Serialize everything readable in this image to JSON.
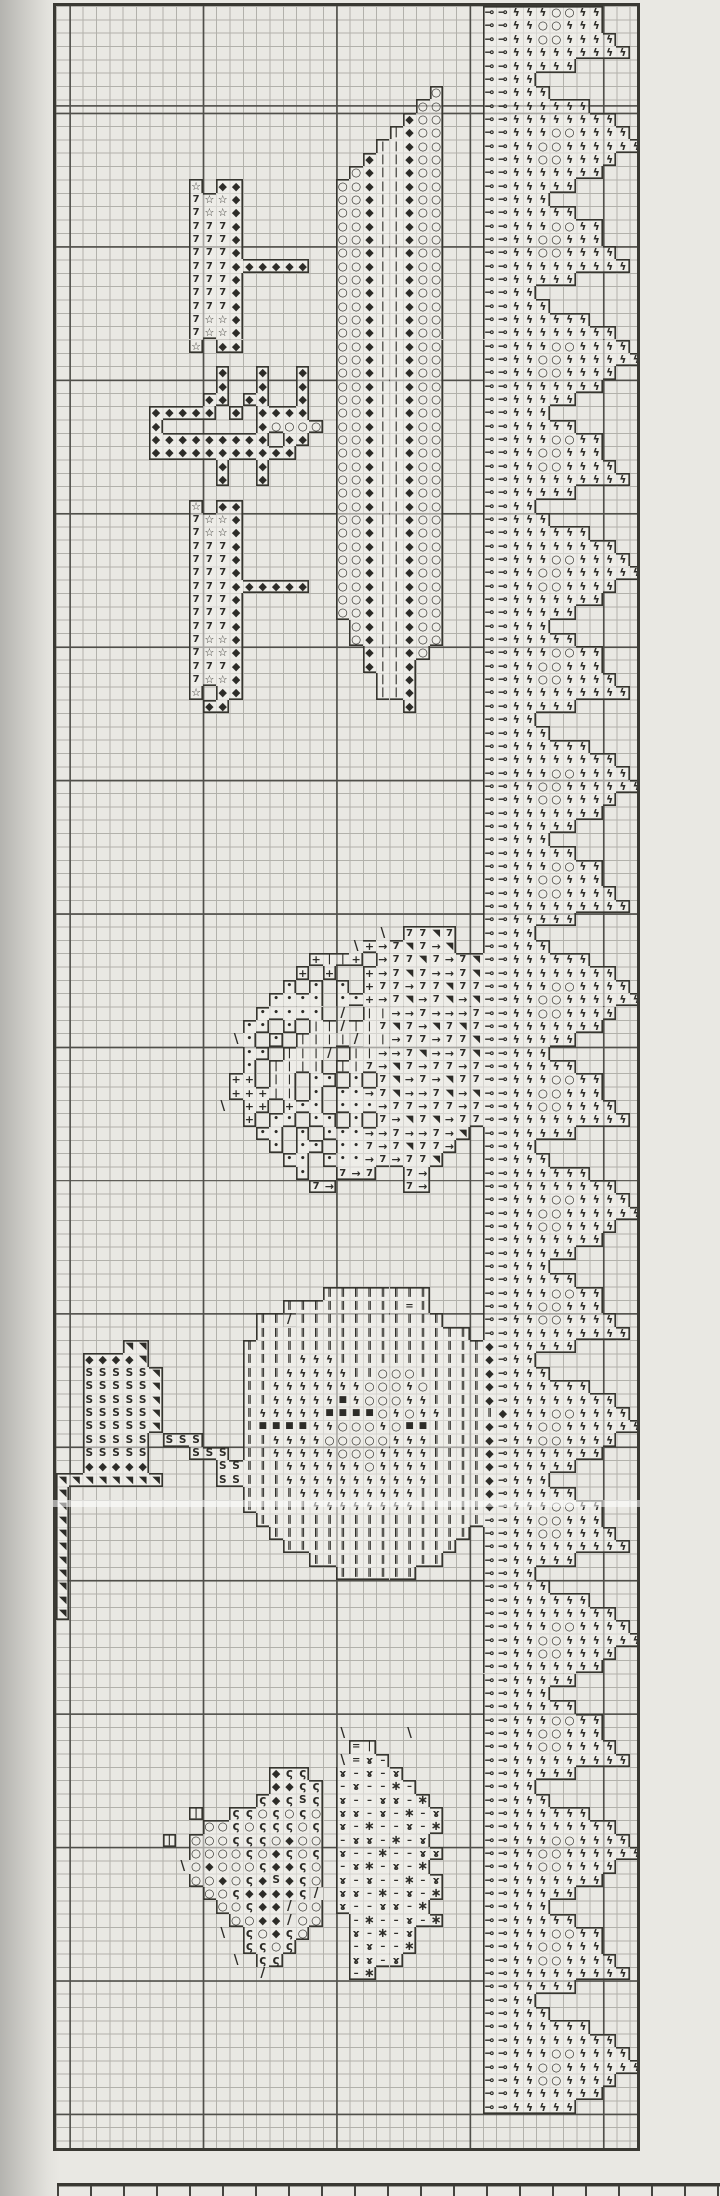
{
  "meta": {
    "description": "Scanned cross-stitch band sampler chart: jagged symbol border on the right, banner tree with 7s and stars, striped column, hedgehog, apple tree with S-trunk and S-block, and beetle motif",
    "paper_color": "#e9e8e3",
    "ink_color": "#2d2c28",
    "grid_line_color": "#b2b1ab",
    "heavy_line_color": "#504f4a"
  },
  "pattern": {
    "cols": 44,
    "rows": 161,
    "symbols": {
      "D": {
        "glyph": "◆",
        "name": "black-diamond",
        "cls": "sym-diamond"
      },
      "O": {
        "glyph": "○",
        "name": "open-circle",
        "cls": "sym-circle"
      },
      "I": {
        "glyph": "|",
        "name": "vertical-dash",
        "cls": "sym-dash"
      },
      "E": {
        "glyph": "‖",
        "name": "double-bar",
        "cls": "sym-dbar"
      },
      "7": {
        "glyph": "7",
        "name": "numeral-seven",
        "cls": "sym-seven"
      },
      "*": {
        "glyph": "☆",
        "name": "open-star",
        "cls": "sym-star"
      },
      "a": {
        "glyph": "⊸",
        "name": "dart",
        "cls": "sym-dart"
      },
      "z": {
        "glyph": "ϟ",
        "name": "lightning-bolt",
        "cls": "sym-bolt"
      },
      ">": {
        "glyph": "→",
        "name": "right-arrow",
        "cls": "sym-arrow"
      },
      "T": {
        "glyph": "◥",
        "name": "filled-triangle",
        "cls": "sym-tri"
      },
      "+": {
        "glyph": "+",
        "name": "plus",
        "cls": "sym-plus"
      },
      "d": {
        "glyph": "•",
        "name": "dot",
        "cls": "sym-dot"
      },
      "S": {
        "glyph": "S",
        "name": "letter-s",
        "cls": ""
      },
      "Q": {
        "glyph": "■",
        "name": "filled-square",
        "cls": "sym-sq"
      },
      "c": {
        "glyph": "ς",
        "name": "comma",
        "cls": "sym-comma"
      },
      "x": {
        "glyph": "ɤ",
        "name": "rams-horn",
        "cls": "sym-horn"
      },
      "-": {
        "glyph": "–",
        "name": "horizontal-bar",
        "cls": "sym-bar"
      },
      "s": {
        "glyph": "∗",
        "name": "asterisk-star",
        "cls": "sym-ast"
      },
      "=": {
        "glyph": "=",
        "name": "double-rule",
        "cls": "sym-eq"
      },
      "/": {
        "glyph": "/",
        "name": "backstitch-up",
        "cls": "",
        "line": true
      },
      "\\": {
        "glyph": "\\",
        "name": "backstitch-down",
        "cls": "",
        "line": true
      }
    },
    "band": {
      "name": "right-border-band",
      "col": 32,
      "rows": 158,
      "unit": [
        "aazzzOOzz...",
        "aazzOOzzz...",
        "aazzOOzzzz..",
        "aazzzzzzzzz.",
        "aazzzzz.....",
        "aazz........",
        "aazzz.......",
        "aazzzzzz....",
        "aazzzzzzzz..",
        "aazzzOOzzzz.",
        "aazzOOzzzzzz",
        "aazzOOzzzz..",
        "aazzzzzzz...",
        "aazzzzz.....",
        "aazzz.......",
        "aazzzzz....."
      ]
    },
    "motifs": [
      {
        "name": "striped-column",
        "col": 21,
        "row": 6,
        "rows": [
          ".......O",
          "......OO",
          ".....DOO",
          "....IDOO",
          "...IIDOO",
          "..DIIDOO",
          ".ODIIDOO",
          "OODIIDOO",
          "OODIIDOO",
          "OODIIDOO",
          "OODIIDOO",
          "OODIIDOO",
          "OODIIDOO",
          "OODIIDOO",
          "OODIIDOO",
          "OODIIDOO",
          "OODIIDOO",
          "OODIIDOO",
          "OODIIDOO",
          "OODIIDOO",
          "OODIIDOO",
          "OODIIDOO",
          "OODIIDOO",
          "OODIIDOO",
          "OODIIDOO",
          "OODIIDOO",
          "OODIIDOO",
          "OODIIDOO",
          "OODIIDOO",
          "OODIIDOO",
          "OODIIDOO",
          "OODIIDOO",
          "OODIIDOO",
          "OODIIDOO",
          "OODIIDOO",
          "OODIIDOO",
          "OODIIDOO",
          "OODIIDOO",
          "OODIIDOO",
          "OODIIDOO",
          ".ODIIDOO",
          ".ODIIDOO",
          "..DIIDO.",
          "..DIID..",
          "...IID..",
          "...IID..",
          ".....D.."
        ]
      },
      {
        "name": "banner-tree",
        "col": 6,
        "row": 13,
        "rows": [
          "....*.DD........",
          "....7**D........",
          "....7**D........",
          "....777D........",
          "....777D........",
          "....777D........",
          "....777DDDDDD...",
          "....777D........",
          "....777D........",
          "....777D........",
          "....7**D........",
          "....7**D........",
          "....*.DD........",
          "................",
          "......D..D..D...",
          "......D..D..D...",
          ".....DD.DD..D...",
          ".DDDDD.D.DDDD...",
          ".D.......DOOOO..",
          ".DDDDDDDDD.DD...",
          ".DDDDDDDDDDD....",
          "......D..D......",
          "......D..D......",
          "................",
          "....*.DD........",
          "....7**D........",
          "....7**D........",
          "....777D........",
          "....777D........",
          "....777D........",
          "....777DDDDDD...",
          "....777D........",
          "....777D........",
          "....777D........",
          "....7**D........",
          "....7**D........",
          "....777D........",
          "....7**D........",
          "....*.DD........",
          ".....DD........."
        ]
      },
      {
        "name": "hedgehog",
        "col": 12,
        "row": 69,
        "rows": [
          "............\\.77T7..",
          "..........\\+>7T7>T..",
          ".......+II+.>77T7>7T",
          "......+.+..+>7T7>>7T",
          ".....d.d.d.+77>77T77",
          "....dddd.dd+>7T>7T>T",
          "...ddddd./.II>>7>>>7",
          "..dd.d.II/II7T7>T7T7",
          ".\\d.d.IIII/II>77>77T",
          "..dd.III/.II>>7T>>7T",
          "..d.IIII.II7>T7>77>7",
          ".++.II.dd.d.7T>7>T77",
          ".+++II.d.dd>7T>>7T>T",
          "\\.++.+dd.ddd>77>77>7",
          "..+.dd.dd.d.7>T7T>77",
          "...dd.d.ddd>>7>>7>T.",
          "....d.dd.dd7>7T77>..",
          ".....dd.ddd>7>77T...",
          "......d..7>7..7>....",
          ".......7>.....7>...."
        ]
      },
      {
        "name": "apple-tree-with-s-trunk",
        "col": 0,
        "row": 96,
        "rows": [
          "....................EEEEEEEE......",
          ".................EEEEEEEEE=E......",
          "...............EE/EEEEEEEEEEE.....",
          "...............EEEEEEEEEEEEEEEE...",
          ".....TT.......EEEEEEEEEEEEEEEEEED.",
          "..DDDDT.......EEEEzzzEEEEEEEEEEED.",
          "..SSSSST......EEEzzzzzEEOOOEEEEED.",
          "..SSSSST......EEzzzzzzzOOOzOEEEED.",
          "..SSSSST......EEzzzzzQzOOOzzEEEED.",
          "..SSSSST......EzzzzzQQQQOzOzzEEEED",
          "..SSSSST......EQQQQzzOOOzOQQEEEED.",
          "..SSSSS.SSS...EEzzzzOOOOOzzzEEEED.",
          "..SSSSS...SSS.EEzzzzzOOOzzzzEEEED.",
          "..DDDDD.....SSEEEzzzzzzOzzzzEEEED.",
          "TTTTTTTT....SSEEEzzzzzzzzzzzEEEED.",
          "T.............EEEEzzzzzzzzzEEEEED.",
          "T.............EEEEEzzzzzzzzEEEEED.",
          "T..............EEEEEEEEEEEEEEEEE..",
          "T...............EEEEEEEEEEEEEEE...",
          "T................EEEEEEEEEEEEE....",
          "T..................EEEEEEEEEE.....",
          "T....................EEEEEE.......",
          "T.................................",
          "T.................................",
          "T................................."
        ]
      },
      {
        "name": "beetle",
        "col": 8,
        "row": 129,
        "rows": [
          ".............\\....\\...",
          "..............=I......",
          ".............\\=x-.....",
          "........Dcc..x-x-x....",
          "........DDcc.-x--s-...",
          ".......cDcSc.x--xx-s..",
          "..I..ccOcOcO.xx-x-s-x.",
          "...OOcOcccOc.x-s--x-s.",
          "I.OOOcccODOO.-xx-s-x..",
          "..OOOOcODcOc.x--s--xx.",
          ".\\ODOOOcDDcO.-xs-x-s..",
          "..OODOcDSDcO.x-x--s-x.",
          "...OOcDDDDc/.xx-s-x-s.",
          "....OOcDD/OO.x--xx-s..",
          ".....OODD/OO..-s--x-s.",
          "....\\.cODcO...x-s-x...",
          "......ccOc....-x--s...",
          ".....\\.cc.....xx-x....",
          "......./......-s......"
        ]
      }
    ]
  }
}
